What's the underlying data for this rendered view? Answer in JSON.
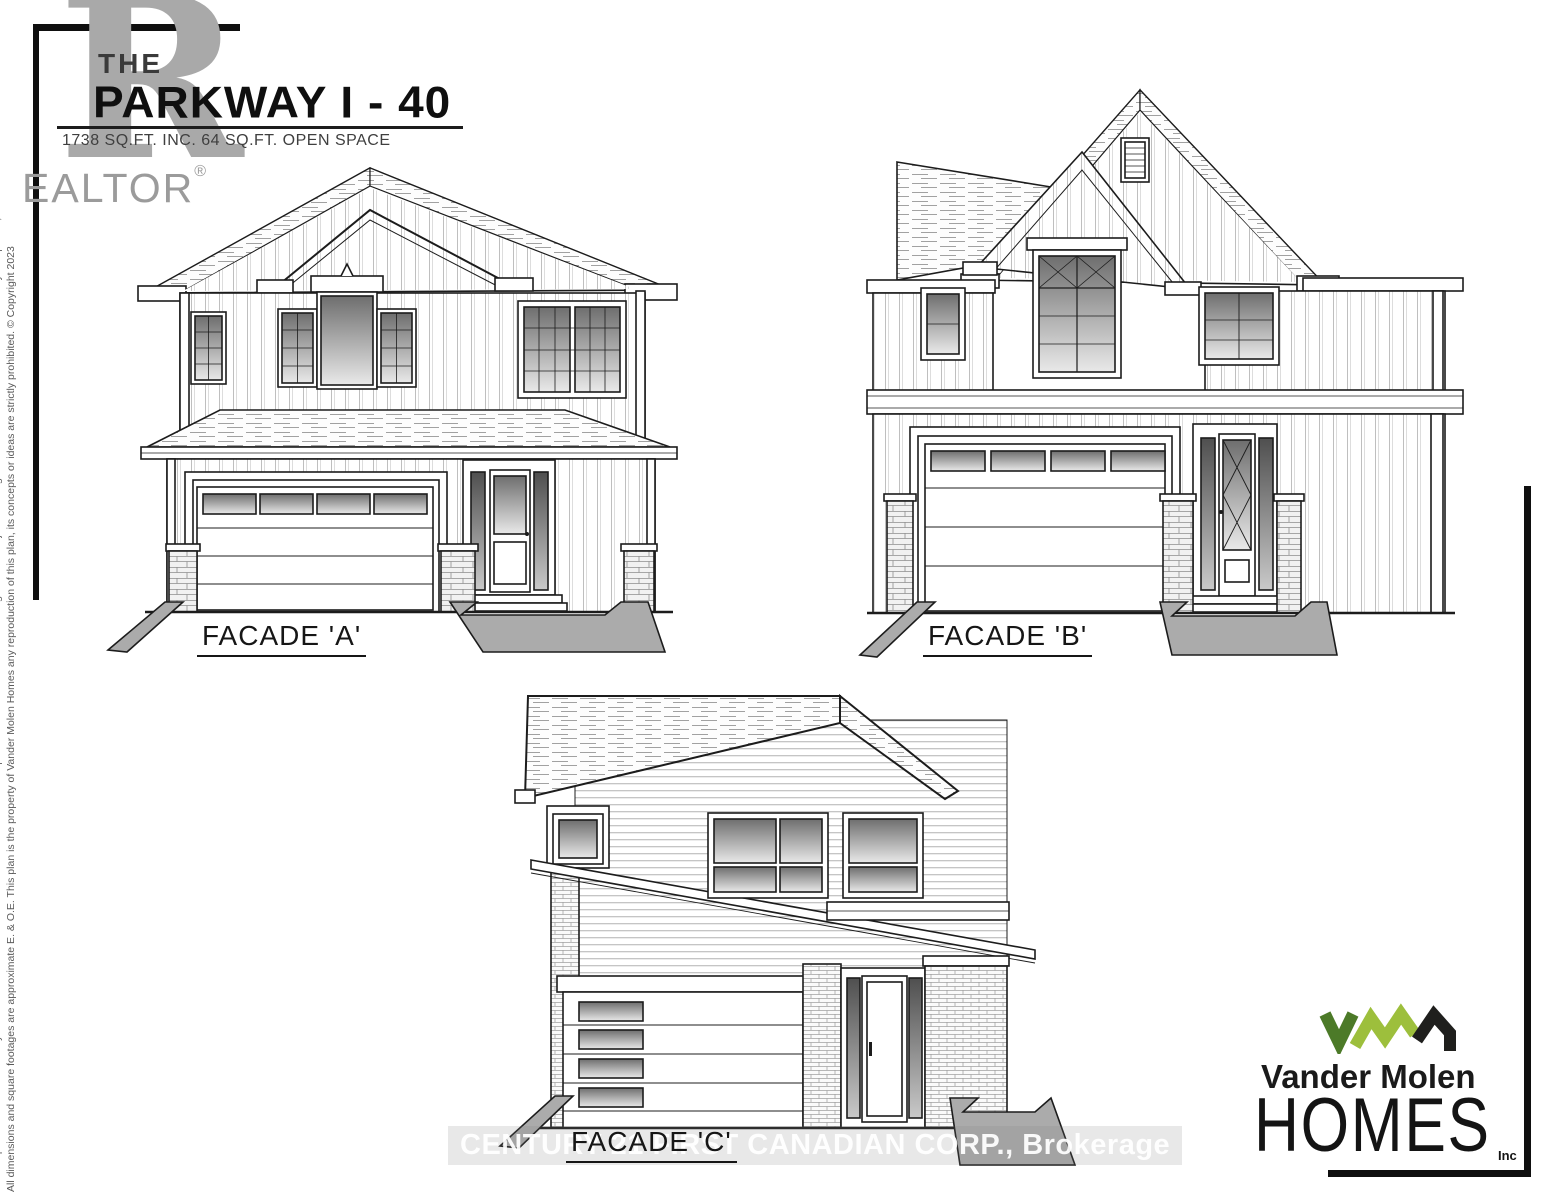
{
  "header": {
    "the_label": "THE",
    "title": "PARKWAY I - 40",
    "subtitle": "1738 SQ.FT. INC. 64 SQ.FT. OPEN SPACE"
  },
  "realtor_logo": {
    "letter": "R",
    "wordmark": "EALTOR",
    "registered_mark": "®"
  },
  "facades": [
    {
      "id": "A",
      "label": "FACADE 'A'"
    },
    {
      "id": "B",
      "label": "FACADE 'B'"
    },
    {
      "id": "C",
      "label": "FACADE 'C'"
    }
  ],
  "watermark": {
    "text": "CENTURY 21 FIRST CANADIAN CORP., Brokerage"
  },
  "builder_logo": {
    "name": "Vander Molen",
    "homes": "HOMES",
    "suffix": "Inc",
    "colors": {
      "v_green": "#4c7a28",
      "m_green": "#9dbf3c",
      "h_black": "#1f1f1d"
    }
  },
  "disclaimer": {
    "line1": "All floor plans and elevations maybe customized to better suit the clients needs. Plans and specifications are an artists rendering and are subject to change without notice. Some features shown may be optional, available at extra costs.",
    "line2": "All dimensions and square footages are approximate E. & O.E. This plan is the property of Vander Molen Homes any reproduction of this plan, its concepts or ideas are strictly prohibited. © Copyright 2023"
  }
}
